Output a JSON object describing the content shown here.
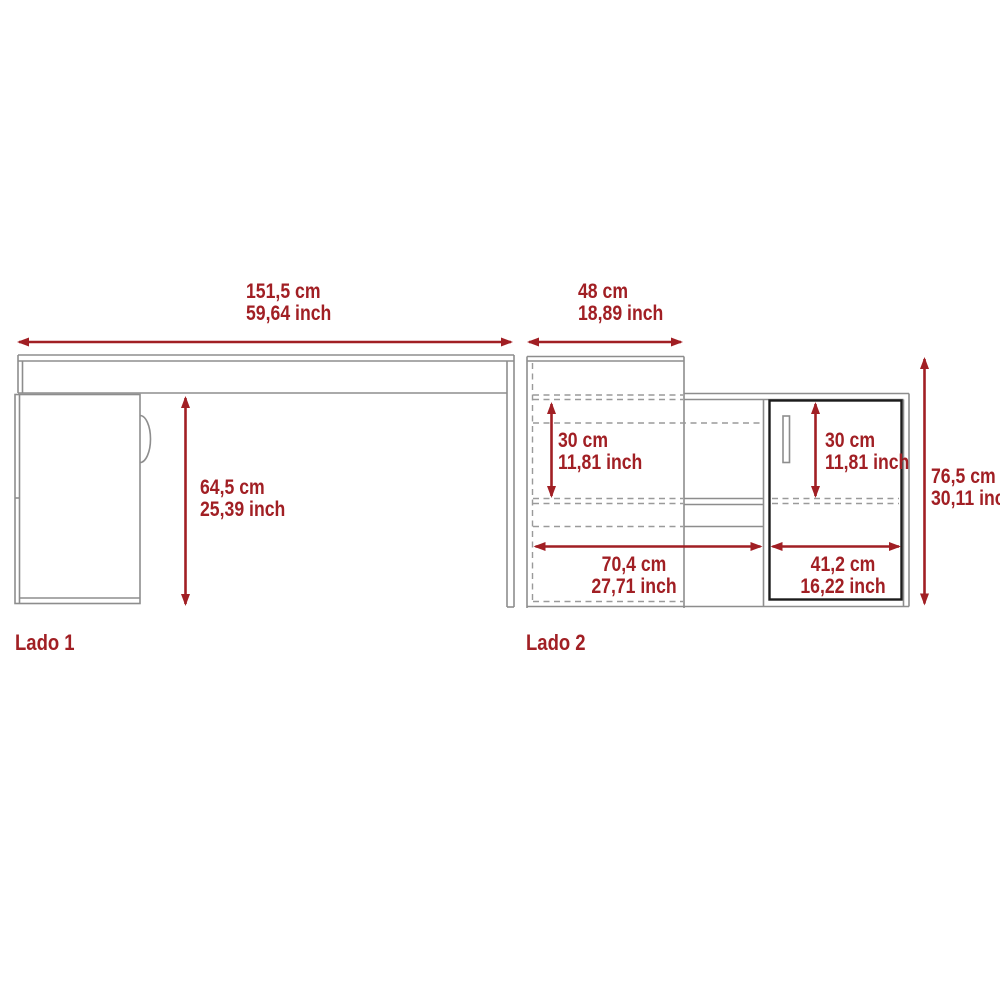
{
  "colors": {
    "accent": "#a11f24",
    "furniture_line": "#8d8d8d",
    "door_outline": "#1c1c1c",
    "background": "#ffffff"
  },
  "side1": {
    "label": "Lado 1",
    "width_cm": "151,5 cm",
    "width_inch": "59,64 inch",
    "height_cm": "64,5 cm",
    "height_inch": "25,39 inch"
  },
  "side2": {
    "label": "Lado 2",
    "depth_cm": "48 cm",
    "depth_inch": "18,89 inch",
    "left_shelf_cm": "30 cm",
    "left_shelf_inch": "11,81 inch",
    "right_shelf_cm": "30 cm",
    "right_shelf_inch": "11,81 inch",
    "left_width_cm": "70,4 cm",
    "left_width_inch": "27,71 inch",
    "right_width_cm": "41,2 cm",
    "right_width_inch": "16,22 inch",
    "height_cm": "76,5 cm",
    "height_inch": "30,11 inch"
  }
}
